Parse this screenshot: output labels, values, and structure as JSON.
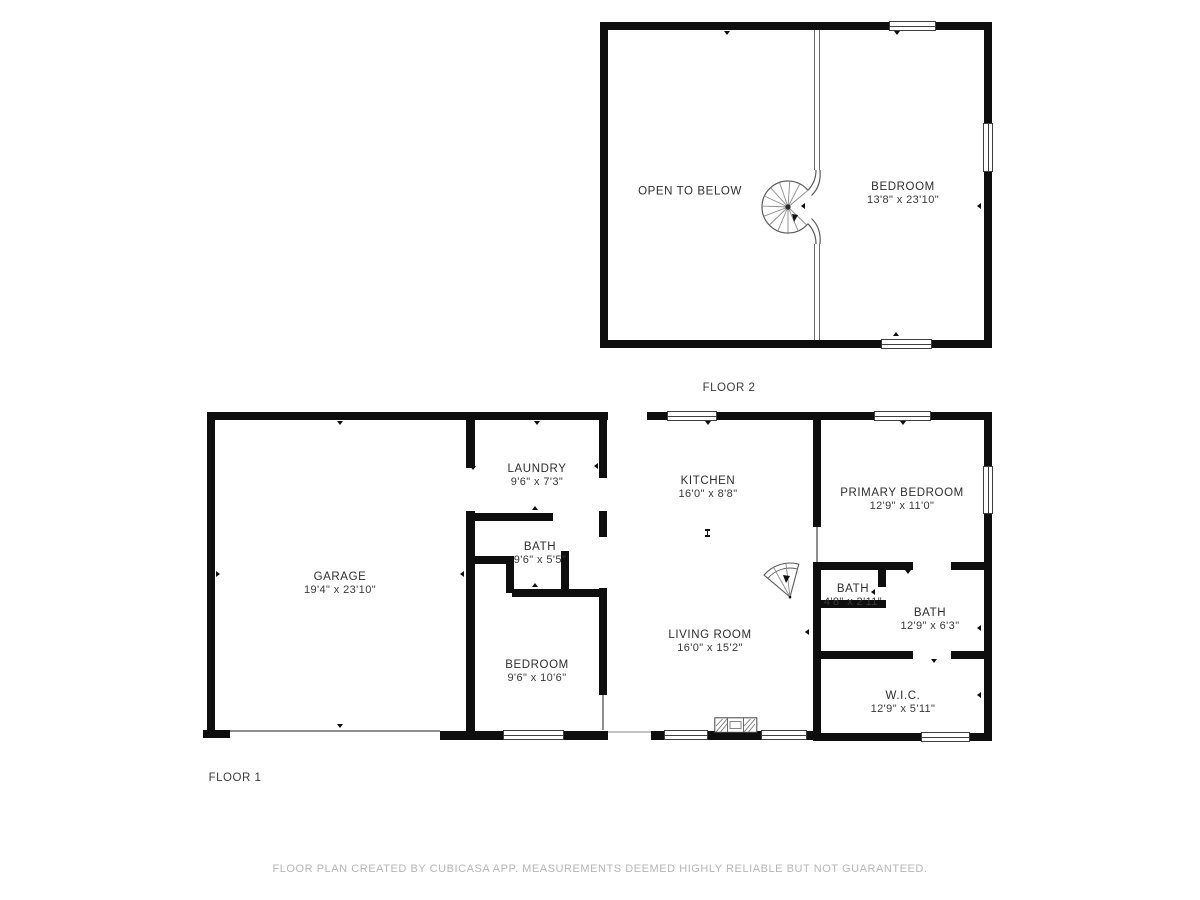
{
  "colors": {
    "wall": "#0e0e0e",
    "room_text": "#2d2d2d",
    "footer_text": "#b5b5b5"
  },
  "floor2": {
    "label": "FLOOR 2",
    "rooms": [
      {
        "name": "OPEN TO BELOW",
        "dims": ""
      },
      {
        "name": "BEDROOM",
        "dims": "13'8\" x 23'10\""
      }
    ]
  },
  "floor1": {
    "label": "FLOOR 1",
    "rooms": [
      {
        "name": "GARAGE",
        "dims": "19'4\" x 23'10\""
      },
      {
        "name": "LAUNDRY",
        "dims": "9'6\" x 7'3\""
      },
      {
        "name": "BATH",
        "dims": "9'6\" x 5'5\""
      },
      {
        "name": "BEDROOM",
        "dims": "9'6\" x 10'6\""
      },
      {
        "name": "KITCHEN",
        "dims": "16'0\" x 8'8\""
      },
      {
        "name": "LIVING ROOM",
        "dims": "16'0\" x 15'2\""
      },
      {
        "name": "PRIMARY BEDROOM",
        "dims": "12'9\" x 11'0\""
      },
      {
        "name": "BATH",
        "dims": "4'8\" x 2'11\""
      },
      {
        "name": "BATH",
        "dims": "12'9\" x 6'3\""
      },
      {
        "name": "W.I.C.",
        "dims": "12'9\" x 5'11\""
      }
    ]
  },
  "footer": {
    "disclaimer": "FLOOR PLAN CREATED BY CUBICASA APP. MEASUREMENTS DEEMED HIGHLY RELIABLE BUT NOT GUARANTEED."
  }
}
